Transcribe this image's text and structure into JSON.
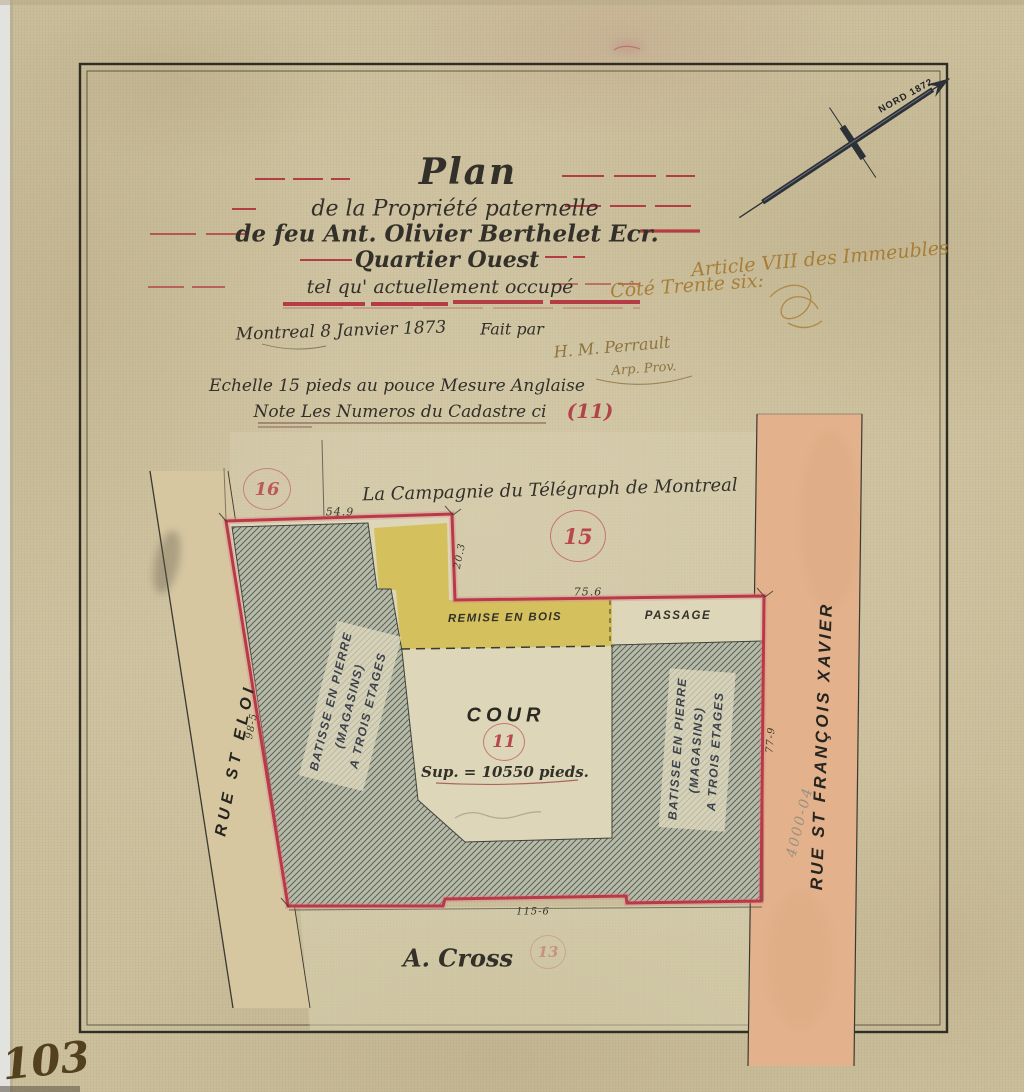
{
  "page": {
    "numberLabel": "103"
  },
  "northArrow": {
    "label": "NORD 1872"
  },
  "titleBlock": {
    "line1": "Plan",
    "line2": "de la Propriété paternelle",
    "line3": "de feu Ant. Olivier Berthelet Ecr.",
    "line4": "Quartier Ouest",
    "line5": "tel qu' actuellement occupé"
  },
  "annotations": {
    "article": "Article VIII des Immeubles",
    "cote": "Côté Trente six:",
    "dateLine": "Montreal 8 Janvier 1873",
    "faitPar": "Fait par",
    "signature": "H. M. Perrault",
    "signatureTitle": "Arp. Prov.",
    "scaleNote": "Echelle 15 pieds au pouce Mesure Anglaise",
    "cadastreNote": "Note Les Numeros du Cadastre ci",
    "cadastreNumber": "(11)"
  },
  "map": {
    "northLot": "La Campagnie du Télégraph de Montreal",
    "southLot": "A. Cross",
    "streetWest": "RUE ST ELOI",
    "streetEast": "RUE ST FRANÇOIS XAVIER",
    "lotNumbers": {
      "west": "16",
      "north": "15",
      "center": "11",
      "south": "13"
    },
    "buildings": {
      "west": [
        "BATISSE EN PIERRE",
        "(MAGASINS)",
        "A TROIS ETAGES"
      ],
      "east": [
        "BATISSE EN PIERRE",
        "(MAGASINS)",
        "A TROIS ETAGES"
      ],
      "shed": "REMISE EN BOIS",
      "passage": "PASSAGE",
      "court": "COUR",
      "courtArea": "Sup. = 10550 pieds."
    },
    "dimensions": {
      "top": "54.9",
      "step": "20.3",
      "upper": "75.6",
      "bottom": "115-6",
      "west": "98-5",
      "east": "77-9"
    },
    "pencilNote": "4000-04"
  },
  "colors": {
    "paper": "#ccc09d",
    "boundaryRed": "#b93a46",
    "inkRed": "#b2434b",
    "hatchFill": "#b6baa9",
    "yellow": "#d3c059",
    "streetSalmon": "#e3b28c",
    "inkBlack": "#33302a",
    "inkBrown": "#a3782e"
  }
}
